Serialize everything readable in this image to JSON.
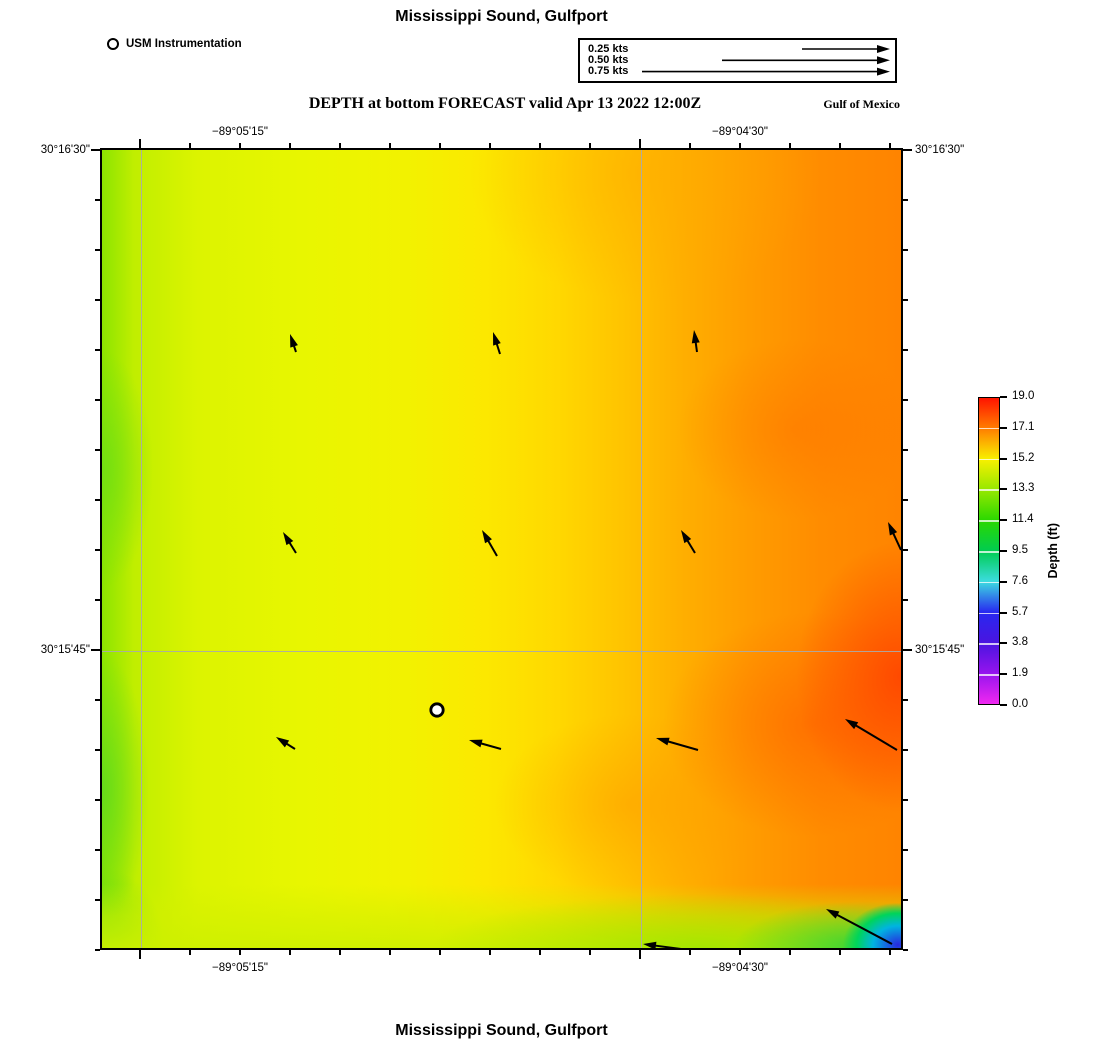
{
  "header": {
    "title": "Mississippi Sound, Gulfport",
    "station_legend": {
      "label": "USM Instrumentation"
    },
    "scale_box": {
      "rows": [
        {
          "label": "0.25 kts",
          "arrow_len_px": 88
        },
        {
          "label": "0.50 kts",
          "arrow_len_px": 168
        },
        {
          "label": "0.75 kts",
          "arrow_len_px": 248
        }
      ]
    },
    "subtitle": "DEPTH at bottom FORECAST valid Apr 13 2022 12:00Z",
    "region_label": "Gulf of Mexico"
  },
  "footer": {
    "title": "Mississippi Sound, Gulfport"
  },
  "chart_data": {
    "type": "heatmap",
    "title": "DEPTH at bottom FORECAST valid Apr 13 2022 12:00Z",
    "place": "Mississippi Sound, Gulfport",
    "region": "Gulf of Mexico",
    "map": {
      "width_px": 803,
      "height_px": 802,
      "lon_ticks": [
        {
          "label": "−89°05'15\"",
          "px": 40
        },
        {
          "label": "−89°04'30\"",
          "px": 540
        }
      ],
      "lat_ticks": [
        {
          "label": "30°16'30\"",
          "px": 2
        },
        {
          "label": "30°15'45\"",
          "px": 502
        }
      ],
      "minor_tick_spacing_px": 50,
      "grid_color": "#aaaaaa"
    },
    "colorbar": {
      "label": "Depth (ft)",
      "min": 0.0,
      "max": 19.0,
      "tick_labels": [
        "19.0",
        "17.1",
        "15.2",
        "13.3",
        "11.4",
        "9.5",
        "7.6",
        "5.7",
        "3.8",
        "1.9",
        "0.0"
      ],
      "stops": [
        {
          "v": 19.0,
          "c": "#ff1400"
        },
        {
          "v": 17.1,
          "c": "#ff7e00"
        },
        {
          "v": 15.2,
          "c": "#f8f000"
        },
        {
          "v": 13.3,
          "c": "#96e800"
        },
        {
          "v": 11.4,
          "c": "#2ad800"
        },
        {
          "v": 9.5,
          "c": "#00cc50"
        },
        {
          "v": 7.6,
          "c": "#3cdce0"
        },
        {
          "v": 5.7,
          "c": "#2828f0"
        },
        {
          "v": 3.8,
          "c": "#4a14e0"
        },
        {
          "v": 1.9,
          "c": "#9614ee"
        },
        {
          "v": 0.0,
          "c": "#f028f0"
        }
      ]
    },
    "station": {
      "label": "USM Instrumentation",
      "x": 337,
      "y": 562
    },
    "current_vectors": [
      {
        "tail": [
          196,
          204
        ],
        "head": [
          190,
          186
        ]
      },
      {
        "tail": [
          400,
          206
        ],
        "head": [
          393,
          184
        ]
      },
      {
        "tail": [
          597,
          204
        ],
        "head": [
          594,
          182
        ]
      },
      {
        "tail": [
          196,
          405
        ],
        "head": [
          183,
          384
        ]
      },
      {
        "tail": [
          397,
          408
        ],
        "head": [
          382,
          382
        ]
      },
      {
        "tail": [
          595,
          405
        ],
        "head": [
          581,
          382
        ]
      },
      {
        "tail": [
          801,
          402
        ],
        "head": [
          788,
          374
        ]
      },
      {
        "tail": [
          195,
          601
        ],
        "head": [
          176,
          589
        ]
      },
      {
        "tail": [
          401,
          601
        ],
        "head": [
          369,
          592
        ]
      },
      {
        "tail": [
          598,
          602
        ],
        "head": [
          556,
          590
        ]
      },
      {
        "tail": [
          797,
          602
        ],
        "head": [
          745,
          571
        ]
      },
      {
        "tail": [
          581,
          801
        ],
        "head": [
          543,
          796
        ]
      },
      {
        "tail": [
          792,
          796
        ],
        "head": [
          726,
          761
        ]
      }
    ],
    "approx_depth_samples_ft": [
      {
        "x_px": 40,
        "y_px": 300,
        "depth_ft": 13.0
      },
      {
        "x_px": 250,
        "y_px": 250,
        "depth_ft": 15.0
      },
      {
        "x_px": 450,
        "y_px": 150,
        "depth_ft": 16.0
      },
      {
        "x_px": 650,
        "y_px": 400,
        "depth_ft": 17.0
      },
      {
        "x_px": 780,
        "y_px": 520,
        "depth_ft": 18.5
      },
      {
        "x_px": 400,
        "y_px": 620,
        "depth_ft": 15.5
      },
      {
        "x_px": 600,
        "y_px": 790,
        "depth_ft": 13.5
      },
      {
        "x_px": 770,
        "y_px": 780,
        "depth_ft": 11.0
      },
      {
        "x_px": 798,
        "y_px": 797,
        "depth_ft": 4.0
      }
    ]
  }
}
